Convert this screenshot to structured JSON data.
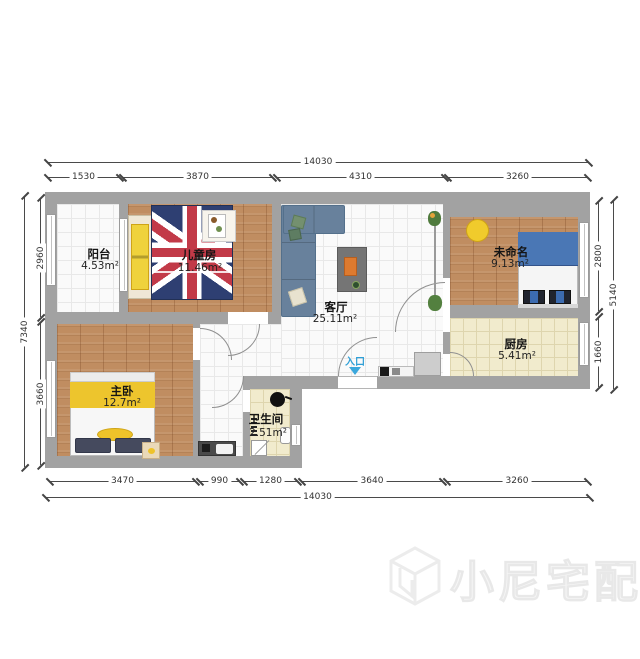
{
  "dimensions": {
    "top": {
      "total": "14030",
      "segments": [
        "1530",
        "3870",
        "4310",
        "3260"
      ]
    },
    "bottom": {
      "total": "14030",
      "segments": [
        "3470",
        "990",
        "1280",
        "3640",
        "3260"
      ]
    },
    "left": {
      "total": "7340",
      "segments": [
        "2960",
        "3660"
      ]
    },
    "right": {
      "total": "5140",
      "segments": [
        "2800",
        "1660"
      ]
    }
  },
  "rooms": {
    "balcony": {
      "name": "阳台",
      "area": "4.53m²"
    },
    "kids": {
      "name": "儿童房",
      "area": "11.46m²"
    },
    "living": {
      "name": "客厅",
      "area": "25.11m²"
    },
    "unnamed": {
      "name": "未命名",
      "area": "9.13m²"
    },
    "kitchen": {
      "name": "厨房",
      "area": "5.41m²"
    },
    "master": {
      "name": "主卧",
      "area": "12.7m²"
    },
    "bath": {
      "name": "卫生间",
      "area": "2.51m²"
    }
  },
  "entrance": {
    "label": "入口"
  },
  "watermark": {
    "text": "小尼宅配"
  },
  "colors": {
    "wall": "#a2a2a2",
    "wood_floor": "#c08d61",
    "cream_floor": "#f1ebcd",
    "sofa_blue": "#68819c",
    "bed_blue": "#4a77b5",
    "accent_yellow": "#eec52d",
    "entrance_blue": "#2f9fd6"
  }
}
